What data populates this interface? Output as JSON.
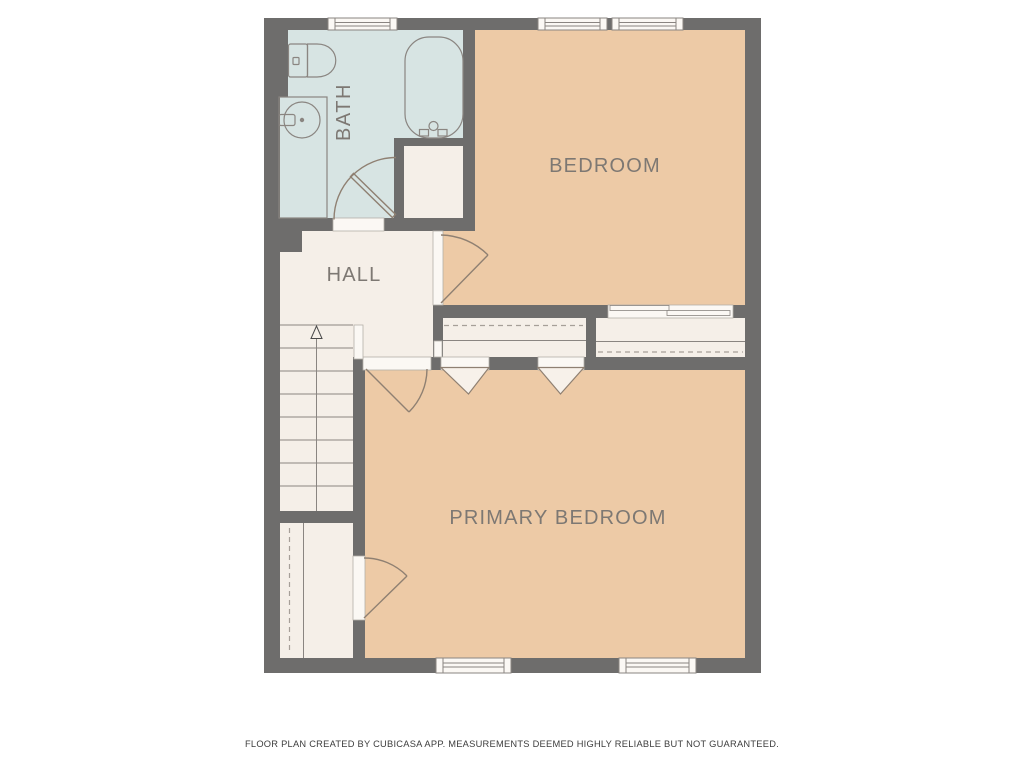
{
  "plan": {
    "title": "Upper floor plan",
    "rooms": [
      {
        "id": "bath",
        "label": "BATH",
        "fill": "#d7e4e3"
      },
      {
        "id": "bedroom",
        "label": "BEDROOM",
        "fill": "#edcaa6"
      },
      {
        "id": "hall",
        "label": "HALL",
        "fill": "#f5efe8"
      },
      {
        "id": "primary-bedroom",
        "label": "PRIMARY BEDROOM",
        "fill": "#edcaa6"
      }
    ],
    "closet_fill": "#f5efe8",
    "fixtures": [
      "toilet",
      "vanity-sink",
      "bathtub",
      "stairs",
      "closet-rods",
      "doors",
      "windows"
    ],
    "stairs": {
      "direction": "up"
    },
    "footer": "FLOOR PLAN CREATED BY CUBICASA APP. MEASUREMENTS DEEMED HIGHLY RELIABLE BUT NOT GUARANTEED.",
    "colors": {
      "background": "#ffffff",
      "wall": "#6e6d6c",
      "opening": "#fbf8f4",
      "fixture_line": "#8a8581",
      "door_line": "#8f8072",
      "label_text": "#7d7873",
      "footer_text": "#3d3d3d"
    }
  }
}
